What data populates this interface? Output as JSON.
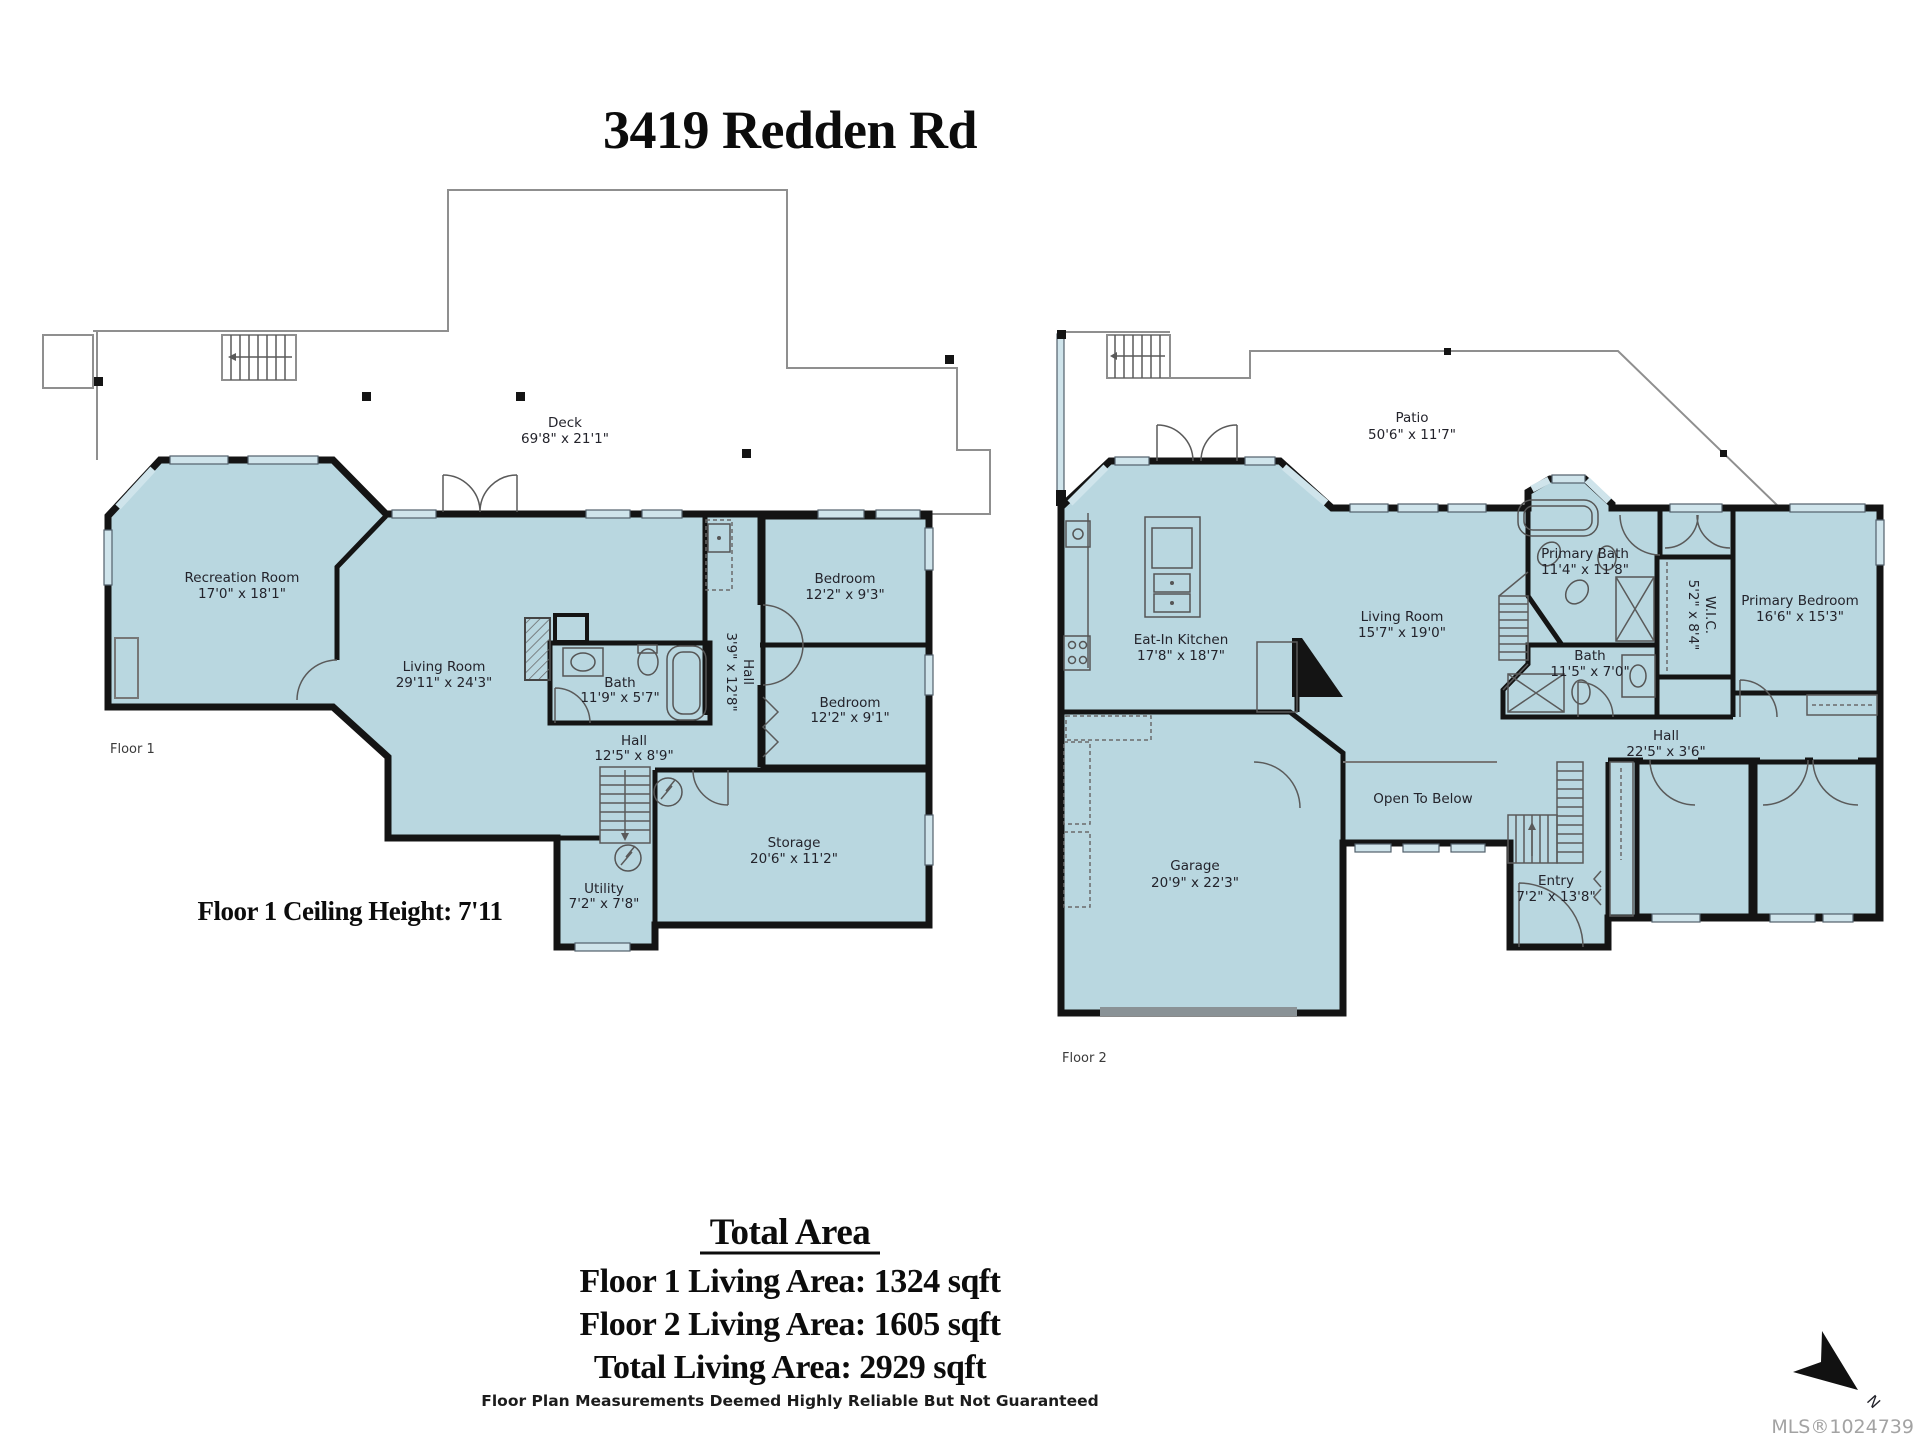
{
  "title": "3419 Redden Rd",
  "floor1": {
    "label": "Floor 1",
    "ceiling_note": "Floor 1 Ceiling Height: 7'11",
    "rooms": {
      "deck": {
        "name": "Deck",
        "dims": "69'8\" x 21'1\""
      },
      "recreation": {
        "name": "Recreation Room",
        "dims": "17'0\" x 18'1\""
      },
      "living": {
        "name": "Living Room",
        "dims": "29'11\" x 24'3\""
      },
      "bath": {
        "name": "Bath",
        "dims": "11'9\" x 5'7\""
      },
      "hall_vertical": {
        "name": "Hall",
        "dims": "3'9\" x 12'8\""
      },
      "hall": {
        "name": "Hall",
        "dims": "12'5\" x 8'9\""
      },
      "bedroom_top": {
        "name": "Bedroom",
        "dims": "12'2\" x 9'3\""
      },
      "bedroom_bottom": {
        "name": "Bedroom",
        "dims": "12'2\" x 9'1\""
      },
      "storage": {
        "name": "Storage",
        "dims": "20'6\" x 11'2\""
      },
      "utility": {
        "name": "Utility",
        "dims": "7'2\" x 7'8\""
      }
    }
  },
  "floor2": {
    "label": "Floor 2",
    "rooms": {
      "patio": {
        "name": "Patio",
        "dims": "50'6\" x 11'7\""
      },
      "kitchen": {
        "name": "Eat-In Kitchen",
        "dims": "17'8\" x 18'7\""
      },
      "living": {
        "name": "Living Room",
        "dims": "15'7\" x 19'0\""
      },
      "primary_bath": {
        "name": "Primary Bath",
        "dims": "11'4\" x 11'8\""
      },
      "wic": {
        "name": "W.I.C.",
        "dims": "5'2\" x 8'4\""
      },
      "primary_bedroom": {
        "name": "Primary Bedroom",
        "dims": "16'6\" x 15'3\""
      },
      "bath": {
        "name": "Bath",
        "dims": "11'5\" x 7'0\""
      },
      "hall": {
        "name": "Hall",
        "dims": "22'5\" x 3'6\""
      },
      "garage": {
        "name": "Garage",
        "dims": "20'9\" x 22'3\""
      },
      "open_to_below": {
        "name": "Open To Below"
      },
      "entry": {
        "name": "Entry",
        "dims": "7'2\" x 13'8\""
      }
    }
  },
  "summary": {
    "heading": "Total Area",
    "floor1_area": "Floor 1 Living Area: 1324 sqft",
    "floor2_area": "Floor 2 Living Area: 1605 sqft",
    "total_area": "Total Living Area: 2929 sqft",
    "disclaimer": "Floor Plan Measurements Deemed Highly Reliable But Not Guaranteed"
  },
  "footer": {
    "mls": "MLS®1024739",
    "north_label": "N"
  },
  "colors": {
    "room_blue": "#b9d7e0",
    "room_green": "#cfdba2",
    "room_yellow": "#f4ecab",
    "wall": "#141414",
    "deck_outline": "#8f8f8f",
    "window": "#cfe4eb"
  }
}
